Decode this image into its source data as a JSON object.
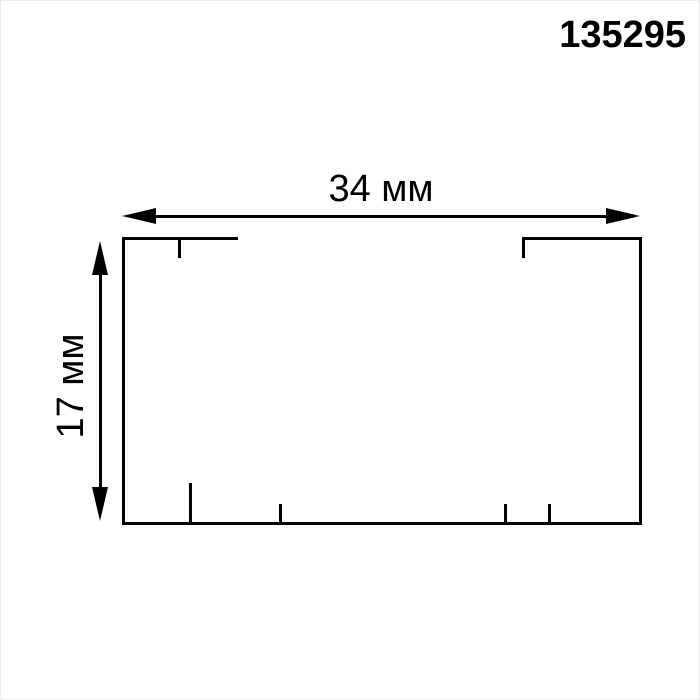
{
  "page": {
    "background_color": "#ffffff",
    "line_color": "#000000",
    "border_color": "#ececec"
  },
  "drawing": {
    "article_number": "135295",
    "width_label": "34 мм",
    "height_label": "17 мм"
  }
}
